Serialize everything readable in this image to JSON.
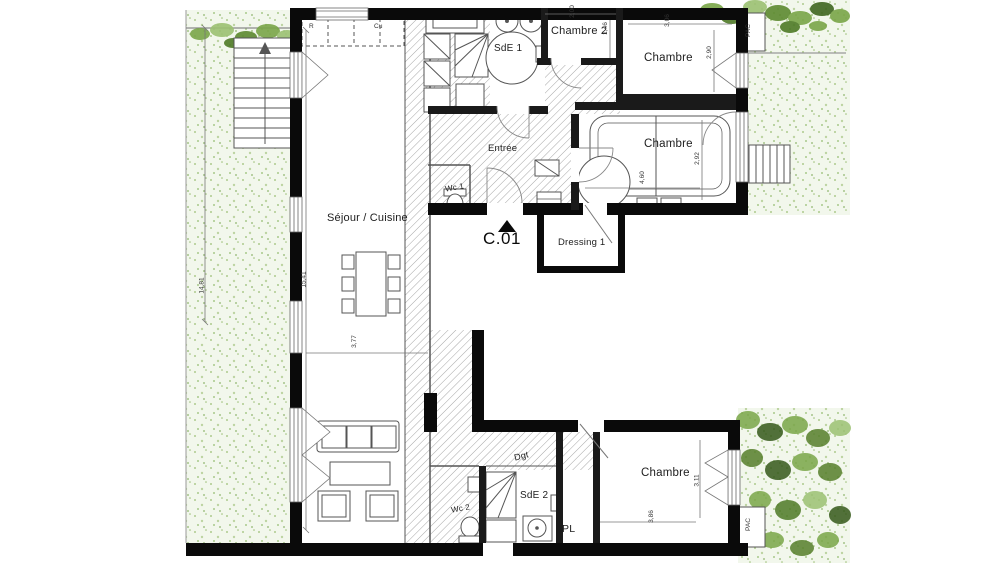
{
  "unit": {
    "label": "C.01"
  },
  "rooms": {
    "sejour": "Séjour / Cuisine",
    "sde1": "SdE 1",
    "chambre2": "Chambre 2",
    "chambre_top": "Chambre",
    "chambre_mid": "Chambre",
    "chambre_bottom": "Chambre",
    "entree": "Entrée",
    "wc1": "Wc 1",
    "wc2": "Wc 2",
    "dressing": "Dressing 1",
    "dgt": "Dgt",
    "sde2": "SdE 2",
    "pl": "PL"
  },
  "equipment": {
    "pac_top": "PAC",
    "pac_bottom": "PAC",
    "fridge": "R",
    "cooking": "Cu"
  },
  "dimensions": {
    "garden_height": "14,81",
    "sejour_height": "15,41",
    "sejour_width": "3,77",
    "chambre2_width": "2,00",
    "chambre2_depth": "1,46",
    "chambre_top_width": "3,06",
    "chambre_top_depth": "2,90",
    "chambre_mid_width": "4,60",
    "chambre_mid_depth": "2,92",
    "chambre_bottom_depth": "3,11",
    "chambre_bottom_width": "3,86"
  },
  "colors": {
    "wall": "#000000",
    "hatch_line": "#a6a6a6",
    "garden_fill": "#f2f7ec",
    "foliage_green": "#7aa648",
    "foliage_dark": "#3f661f",
    "dim_text": "#333333"
  }
}
